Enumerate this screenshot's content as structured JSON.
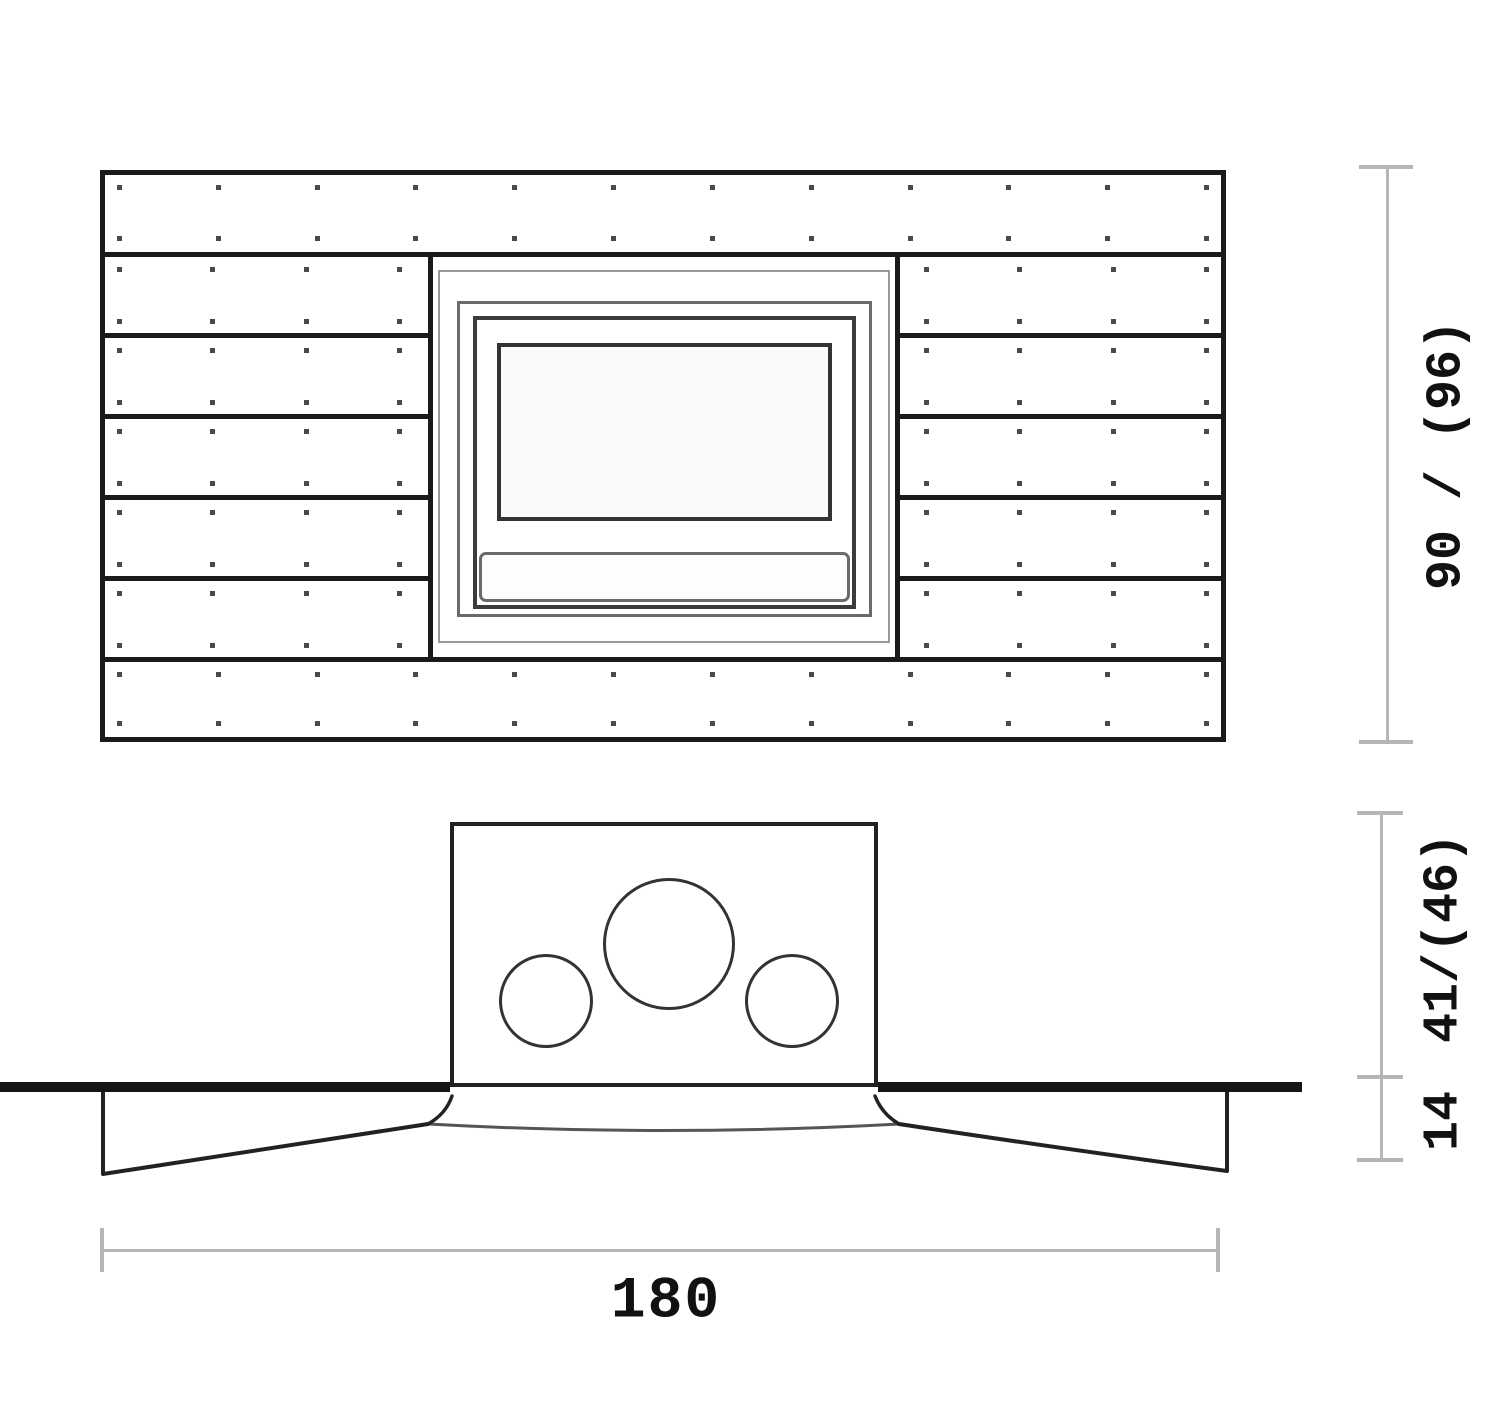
{
  "drawing": {
    "type": "technical-drawing",
    "subject": "wall-mounted fireplace unit, front elevation and ceiling section view"
  },
  "front_view": {
    "full_width_plank_rows": 2,
    "side_plank_rows": 5,
    "dot_rows_per_plank": 2,
    "dot_columns_full": 12,
    "dot_columns_side": 4,
    "insert_frames": 4,
    "insert_parts": [
      "outer-trim",
      "mid-frame",
      "inner-frame",
      "glass-window",
      "vent-bar"
    ]
  },
  "section_view": {
    "duct_circles": 3
  },
  "dimensions": {
    "height_label": "90 / (96)",
    "depth_upper_label": "41/(46)",
    "depth_lower_label": "14",
    "width_label": "180"
  },
  "colors": {
    "line_dark": "#1a1a1a",
    "line_mid": "#3c3c3c",
    "line_gray": "#6a6a6a",
    "line_light": "#9a9a9a",
    "dim_line": "#b6b6b6",
    "dot": "#4a4a4a",
    "text": "#111111",
    "background": "#ffffff"
  }
}
